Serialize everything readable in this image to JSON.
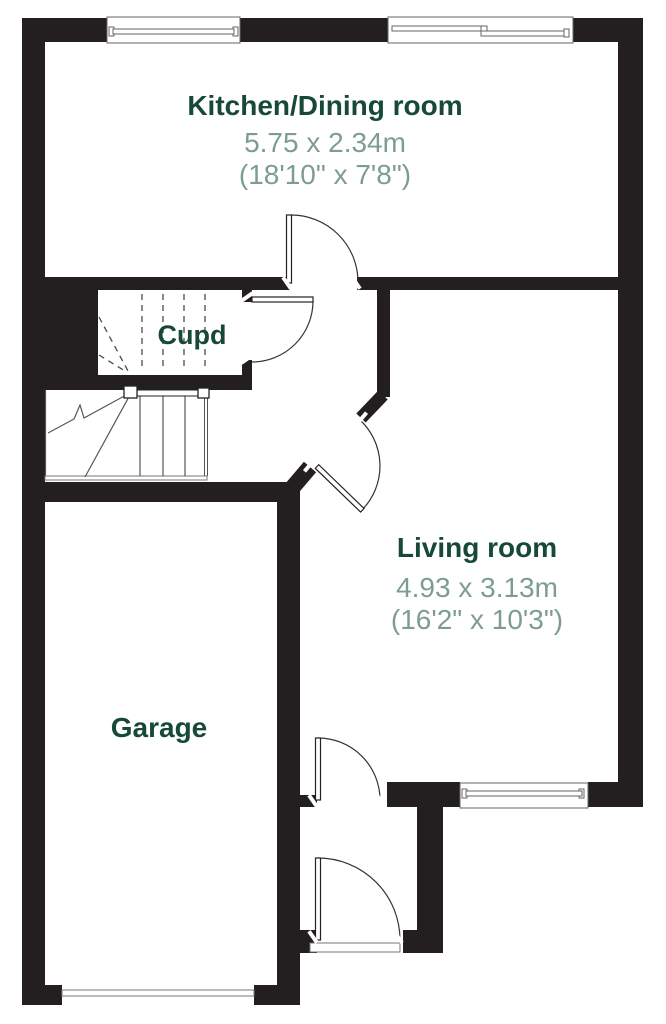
{
  "plan": {
    "colors": {
      "walls": "#231f20",
      "room_name": "#17493a",
      "dimensions": "#7e9d92",
      "background": "#ffffff"
    },
    "rooms": {
      "kitchen": {
        "name": "Kitchen/Dining room",
        "metric": "5.75 x 2.34m",
        "imperial": "(18'10\" x 7'8\")"
      },
      "cupboard": {
        "name": "Cupd"
      },
      "living": {
        "name": "Living room",
        "metric": "4.93 x 3.13m",
        "imperial": "(16'2\" x 10'3\")"
      },
      "garage": {
        "name": "Garage"
      }
    }
  }
}
